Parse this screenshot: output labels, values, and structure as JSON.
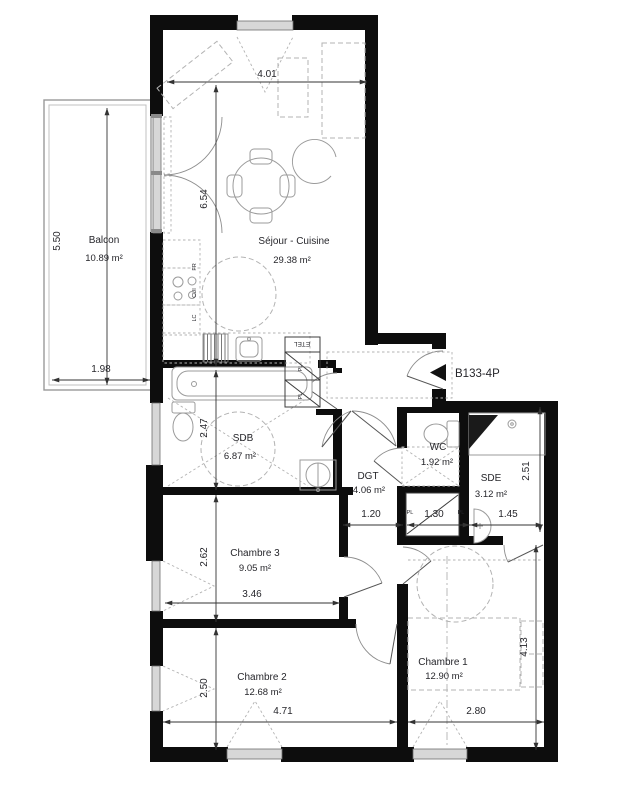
{
  "colors": {
    "bg": "#ffffff",
    "wall": "#0d0d0d",
    "line": "#3c3c3c",
    "text": "#26262b",
    "furniture": "#9b9b9b",
    "dashed": "#b3b3b3",
    "window_fill": "#d7d7d7",
    "window_stroke": "#6f6f6f",
    "dim": "#333333"
  },
  "unit": {
    "label": "B133-4P"
  },
  "rooms": [
    {
      "name": "Balcon",
      "area": "10.89 m²"
    },
    {
      "name": "Séjour - Cuisine",
      "area": "29.38 m²"
    },
    {
      "name": "SDB",
      "area": "6.87 m²"
    },
    {
      "name": "DGT",
      "area": "4.06 m²"
    },
    {
      "name": "WC",
      "area": "1.92 m²"
    },
    {
      "name": "SDE",
      "area": "3.12 m²"
    },
    {
      "name": "Chambre 3",
      "area": "9.05 m²"
    },
    {
      "name": "Chambre 2",
      "area": "12.68 m²"
    },
    {
      "name": "Chambre 1",
      "area": "12.90 m²"
    }
  ],
  "dimensions": {
    "sejour_width": "4.01",
    "sejour_depth": "6.54",
    "balcon_depth": "5.50",
    "balcon_width": "1.98",
    "sdb_depth": "2.47",
    "chambre3_depth": "2.62",
    "chambre2_depth": "2.50",
    "chambre3_width": "3.46",
    "chambre2_width": "4.71",
    "chambre1_width": "2.80",
    "chambre1_depth": "4.13",
    "sde_depth": "2.51",
    "dgt_width": "1.20",
    "placard_left": "1.30",
    "placard_right": "1.45"
  },
  "annotations": {
    "etel": "ETEL",
    "placard": "PL",
    "fridge": "FR",
    "cooker": "CUI",
    "washer": "LC"
  }
}
